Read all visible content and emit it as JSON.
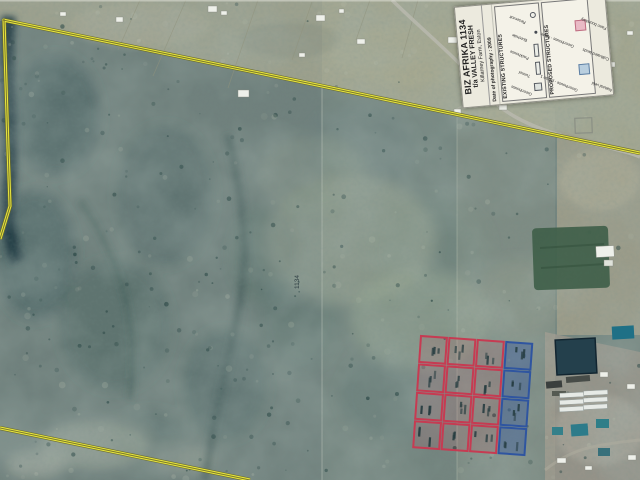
{
  "legend": {
    "title": "BIZ AFRIKA 1134",
    "subtitle": "t/a VALLEY FRESH",
    "location": "Killarney Farm, Eston",
    "date_note": "Date of photography : 2009",
    "existing": {
      "header": "EXISTING STRUCTURES",
      "items": [
        {
          "label": "Greenhouse",
          "symbol": "square"
        },
        {
          "label": "Tunnel",
          "symbol": "wide-rect"
        },
        {
          "label": "Packhouse",
          "symbol": "wide-rect"
        },
        {
          "label": "Borehole",
          "symbol": "dot"
        },
        {
          "label": "Reservoir",
          "symbol": "circle"
        }
      ]
    },
    "proposed": {
      "header": "PROPOSED STRUCTURES",
      "items": [
        {
          "label": "Greenhouse - phase 1",
          "symbol": "square",
          "fill": "#b9cfdf",
          "border": "#5d7fa3"
        },
        {
          "label": "Greenhouse - future",
          "symbol": "square",
          "fill": "#e9bac5",
          "border": "#bf6e82"
        }
      ]
    },
    "landuse_items": [
      {
        "label": "Natural veld",
        "fill": "#d3e2cd",
        "border": "#7a9a77"
      },
      {
        "label": "Cultivated lands",
        "fill": "#dcc98c",
        "border": "#a08f55"
      },
      {
        "label": "Farm boundary",
        "fill": "#ffffff",
        "border": "#8a8a8a"
      }
    ]
  },
  "map": {
    "parcel_label": "1134",
    "boundary_color": "#ece93f",
    "proposed_grid": {
      "rows": 4,
      "cols": 4,
      "blue_col": 3,
      "cell_size": 26,
      "gap": 2.5,
      "origin_x": 421,
      "origin_y": 336,
      "tilt_deg": 4,
      "red_color": "#c63b52",
      "blue_color": "#2f55a0"
    }
  }
}
